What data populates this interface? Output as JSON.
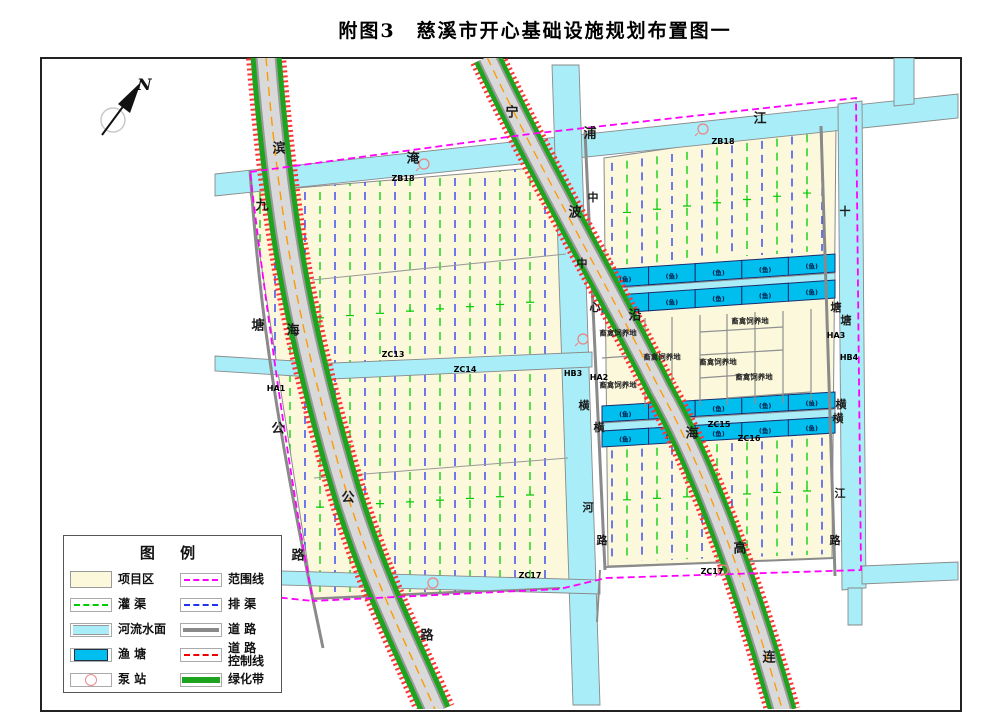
{
  "title": "附图3　慈溪市开心基础设施规划布置图一",
  "compass": {
    "label": "N"
  },
  "legend": {
    "title": "图  例",
    "rows": [
      {
        "left": {
          "type": "area-project",
          "label": "项目区"
        },
        "right": {
          "type": "line-magenta",
          "label": "范围线"
        }
      },
      {
        "left": {
          "type": "line-green",
          "label": "灌  渠"
        },
        "right": {
          "type": "line-blue",
          "label": "排  渠"
        }
      },
      {
        "left": {
          "type": "area-river",
          "label": "河流水面"
        },
        "right": {
          "type": "line-road",
          "label": "道  路"
        }
      },
      {
        "left": {
          "type": "area-pond",
          "label": "渔  塘"
        },
        "right": {
          "type": "line-red",
          "label": "道 路\n控制线"
        }
      },
      {
        "left": {
          "type": "pump",
          "label": "泵  站"
        },
        "right": {
          "type": "line-greenbelt",
          "label": "绿化带"
        }
      }
    ]
  },
  "colors": {
    "project": "#FBF8DC",
    "river": "#A8EDF7",
    "pond": "#00BFEF",
    "boundary": "#FF00FF",
    "canal": "#00CC00",
    "drain": "#2233EE",
    "road": "#8a8a8a",
    "control": "#FF2222",
    "greenbelt": "#1DA31D",
    "centerline": "#FF9900"
  },
  "map": {
    "pond_label": "(鱼)",
    "pond_rows": [
      {
        "x1": 602,
        "y1": 270,
        "x2": 835,
        "y2": 254,
        "h": 18,
        "n": 5
      },
      {
        "x1": 602,
        "y1": 296,
        "x2": 835,
        "y2": 280,
        "h": 18,
        "n": 5
      },
      {
        "x1": 602,
        "y1": 406,
        "x2": 835,
        "y2": 392,
        "h": 16,
        "n": 5
      },
      {
        "x1": 602,
        "y1": 431,
        "x2": 835,
        "y2": 417,
        "h": 16,
        "n": 5
      }
    ],
    "pumps": [
      [
        424,
        164
      ],
      [
        703,
        129
      ],
      [
        583,
        339
      ],
      [
        433,
        583
      ],
      [
        723,
        570
      ]
    ],
    "road_river_labels": [
      {
        "t": "滨",
        "x": 279,
        "y": 148,
        "s": 13
      },
      {
        "t": "海",
        "x": 293,
        "y": 330,
        "s": 13
      },
      {
        "t": "公",
        "x": 348,
        "y": 497,
        "s": 13
      },
      {
        "t": "路",
        "x": 427,
        "y": 635,
        "s": 13
      },
      {
        "t": "九",
        "x": 262,
        "y": 205,
        "s": 13
      },
      {
        "t": "塘",
        "x": 258,
        "y": 325,
        "s": 13
      },
      {
        "t": "公",
        "x": 278,
        "y": 428,
        "s": 13
      },
      {
        "t": "路",
        "x": 298,
        "y": 555,
        "s": 13
      },
      {
        "t": "宁",
        "x": 512,
        "y": 112,
        "s": 13
      },
      {
        "t": "波",
        "x": 575,
        "y": 212,
        "s": 13
      },
      {
        "t": "沿",
        "x": 635,
        "y": 315,
        "s": 13
      },
      {
        "t": "海",
        "x": 692,
        "y": 433,
        "s": 13
      },
      {
        "t": "高",
        "x": 740,
        "y": 548,
        "s": 13
      },
      {
        "t": "连",
        "x": 769,
        "y": 657,
        "s": 13
      },
      {
        "t": "淹",
        "x": 413,
        "y": 158,
        "s": 13
      },
      {
        "t": "浦",
        "x": 590,
        "y": 133,
        "s": 13
      },
      {
        "t": "江",
        "x": 760,
        "y": 118,
        "s": 13
      },
      {
        "t": "中",
        "x": 593,
        "y": 197,
        "s": 11
      },
      {
        "t": "中",
        "x": 582,
        "y": 263,
        "s": 11
      },
      {
        "t": "心",
        "x": 595,
        "y": 307,
        "s": 11
      },
      {
        "t": "横",
        "x": 584,
        "y": 405,
        "s": 11
      },
      {
        "t": "横",
        "x": 599,
        "y": 427,
        "s": 11
      },
      {
        "t": "河",
        "x": 588,
        "y": 507,
        "s": 11
      },
      {
        "t": "路",
        "x": 602,
        "y": 540,
        "s": 11
      },
      {
        "t": "十",
        "x": 845,
        "y": 211,
        "s": 11
      },
      {
        "t": "塘",
        "x": 836,
        "y": 307,
        "s": 11
      },
      {
        "t": "塘",
        "x": 846,
        "y": 320,
        "s": 11
      },
      {
        "t": "横",
        "x": 841,
        "y": 404,
        "s": 11
      },
      {
        "t": "横",
        "x": 838,
        "y": 418,
        "s": 11
      },
      {
        "t": "江",
        "x": 840,
        "y": 493,
        "s": 11
      },
      {
        "t": "路",
        "x": 835,
        "y": 540,
        "s": 11
      }
    ],
    "code_labels": [
      {
        "t": "ZB18",
        "x": 403,
        "y": 178
      },
      {
        "t": "ZB18",
        "x": 723,
        "y": 141
      },
      {
        "t": "ZC13",
        "x": 393,
        "y": 354
      },
      {
        "t": "ZC14",
        "x": 465,
        "y": 369
      },
      {
        "t": "HB3",
        "x": 573,
        "y": 373
      },
      {
        "t": "HA2",
        "x": 599,
        "y": 377
      },
      {
        "t": "HA1",
        "x": 276,
        "y": 388
      },
      {
        "t": "HA3",
        "x": 836,
        "y": 335
      },
      {
        "t": "HB4",
        "x": 849,
        "y": 357
      },
      {
        "t": "ZC15",
        "x": 719,
        "y": 424
      },
      {
        "t": "ZC16",
        "x": 749,
        "y": 438
      },
      {
        "t": "ZC17",
        "x": 530,
        "y": 575
      },
      {
        "t": "ZC17",
        "x": 712,
        "y": 571
      }
    ],
    "area_label": "畜禽饲养地",
    "area_label_pos": [
      [
        618,
        333
      ],
      [
        662,
        357
      ],
      [
        718,
        362
      ],
      [
        750,
        321
      ],
      [
        754,
        377
      ],
      [
        618,
        385
      ]
    ]
  }
}
